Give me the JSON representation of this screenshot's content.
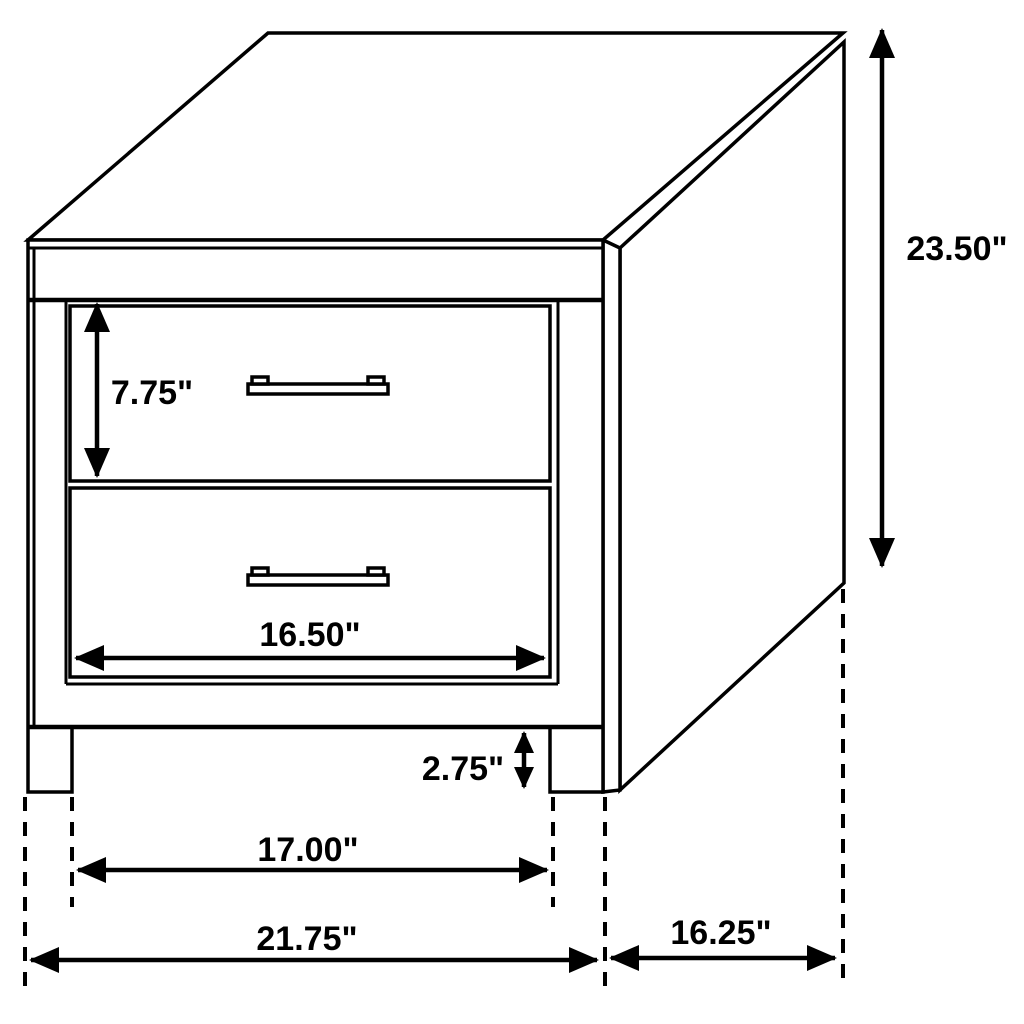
{
  "diagram": {
    "type": "furniture-dimension-diagram",
    "subject": "two-drawer nightstand, oblique projection line drawing",
    "background_color": "#ffffff",
    "line_color": "#000000",
    "text_color": "#000000",
    "dimensions": {
      "total_height": "23.50\"",
      "top_drawer_height": "7.75\"",
      "drawer_width": "16.50\"",
      "leg_clearance_height": "2.75\"",
      "inner_leg_width": "17.00\"",
      "total_width": "21.75\"",
      "total_depth": "16.25\""
    }
  }
}
